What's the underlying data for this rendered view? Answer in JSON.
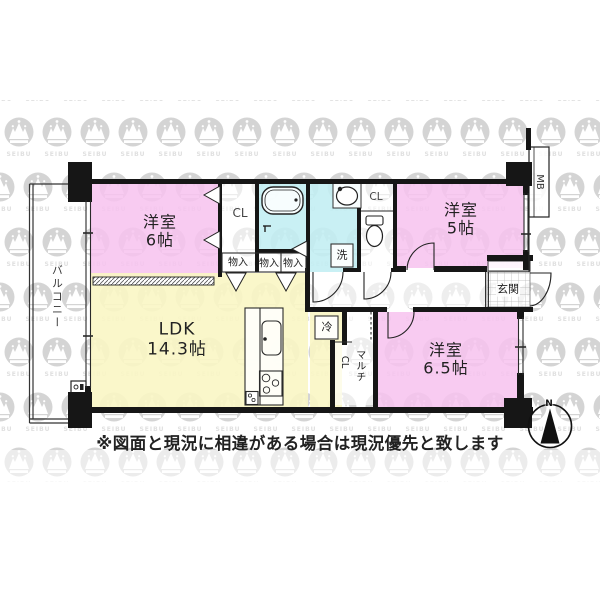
{
  "watermark": {
    "brand": "SEIBU"
  },
  "rooms": {
    "western6": {
      "name": "洋室",
      "size": "6帖"
    },
    "western5": {
      "name": "洋室",
      "size": "5帖"
    },
    "western65": {
      "name": "洋室",
      "size": "6.5帖"
    },
    "ldk": {
      "name": "LDK",
      "size": "14.3帖"
    }
  },
  "spaces": {
    "balcony": "バルコニー",
    "entrance": "玄関",
    "closet_left": "CL",
    "closet_right": "CL",
    "multi_closet_kana": "マルチ",
    "multi_closet_suffix": "CL",
    "storage1": "物入",
    "storage2": "物入",
    "storage3": "物入",
    "washer": "洗",
    "fridge": "冷",
    "meter_box": "MB"
  },
  "compass": {
    "north": "N"
  },
  "disclaimer": "※図面と現況に相違がある場合は現況優先と致します",
  "colors": {
    "room_pink": "#f7c2ee",
    "ldk_yellow": "#faf6c4",
    "wet_cyan": "#c2eef3",
    "wall": "#161616",
    "watermark_gray": "#d4d4d4",
    "watermark_text": "#e0e0e0"
  }
}
